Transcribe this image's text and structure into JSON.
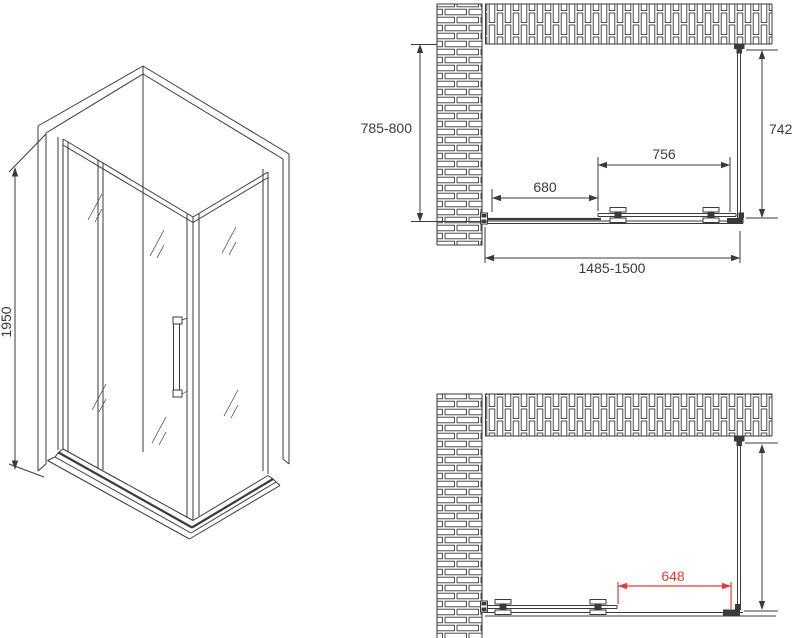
{
  "title": "Shower enclosure technical drawing",
  "colors": {
    "line": "#3a3a3a",
    "dim_red": "#e23b3b",
    "background": "#ffffff"
  },
  "views": {
    "isometric": {
      "name": "isometric-view",
      "dims": {
        "height": "1950"
      }
    },
    "plan_closed": {
      "name": "plan-view-door-closed",
      "dims": {
        "depth": "785-800",
        "side_panel": "742",
        "door": "756",
        "fixed_panel": "680",
        "width": "1485-1500"
      }
    },
    "plan_open": {
      "name": "plan-view-door-open",
      "dims": {
        "opening": "648"
      }
    }
  }
}
